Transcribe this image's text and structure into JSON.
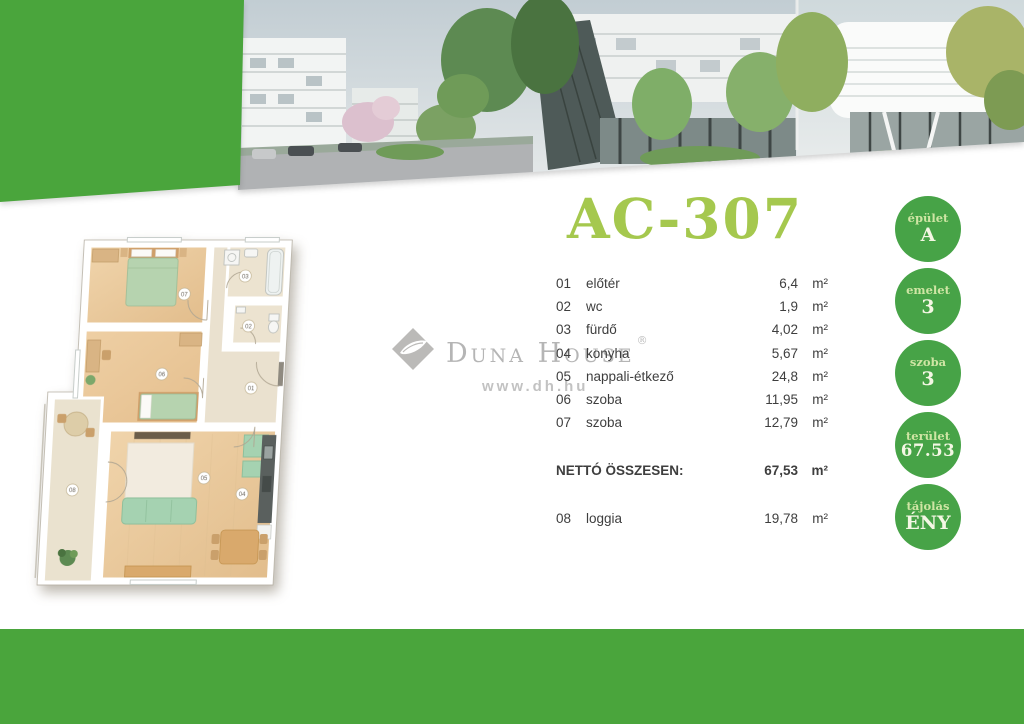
{
  "page": {
    "width": 1024,
    "height": 724
  },
  "colors": {
    "band_green": "#4AA53C",
    "badge_green": "#47A347",
    "title_green": "#A5C84E",
    "text_dark": "#3E3E3E",
    "watermark_gray": "#A8A8A8"
  },
  "header": {
    "photos": [
      {
        "name": "apartment-buildings-street-view"
      },
      {
        "name": "courtyard-dark-facade-building-view"
      },
      {
        "name": "curved-white-building-entrance-view"
      }
    ]
  },
  "unit": {
    "title": "AC-307"
  },
  "rooms": {
    "items": [
      {
        "num": "01",
        "name": "előtér",
        "area": "6,4",
        "unit": "m²"
      },
      {
        "num": "02",
        "name": "wc",
        "area": "1,9",
        "unit": "m²"
      },
      {
        "num": "03",
        "name": "fürdő",
        "area": "4,02",
        "unit": "m²"
      },
      {
        "num": "04",
        "name": "konyha",
        "area": "5,67",
        "unit": "m²"
      },
      {
        "num": "05",
        "name": "nappali-étkező",
        "area": "24,8",
        "unit": "m²"
      },
      {
        "num": "06",
        "name": "szoba",
        "area": "11,95",
        "unit": "m²"
      },
      {
        "num": "07",
        "name": "szoba",
        "area": "12,79",
        "unit": "m²"
      }
    ],
    "total": {
      "label": "NETTÓ ÖSSZESEN:",
      "area": "67,53",
      "unit": "m²"
    },
    "extra": {
      "num": "08",
      "name": "loggia",
      "area": "19,78",
      "unit": "m²"
    }
  },
  "badges": [
    {
      "label": "épület",
      "value": "A"
    },
    {
      "label": "emelet",
      "value": "3"
    },
    {
      "label": "szoba",
      "value": "3"
    },
    {
      "label": "terület",
      "value": "67.53"
    },
    {
      "label": "tájolás",
      "value": "ÉNY"
    }
  ],
  "watermark": {
    "text": "Duna House",
    "reg": "®",
    "url": "www.dh.hu",
    "logo_icon": "duna-house-diamond-leaf-icon"
  }
}
